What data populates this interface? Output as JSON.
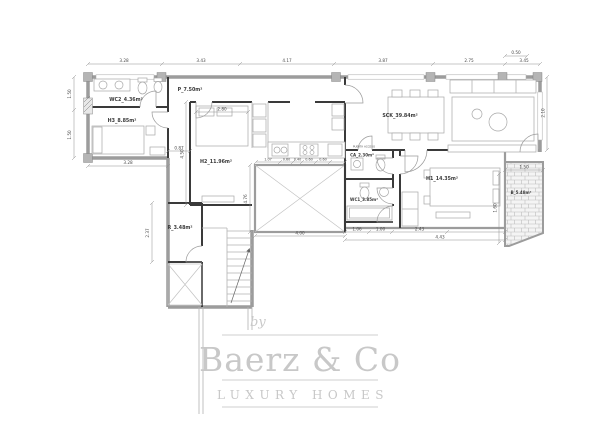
{
  "watermark": {
    "by": "by",
    "brand": "Baerz & Co",
    "tagline": "LUXURY HOMES"
  },
  "rooms": {
    "wc2": "WC2_4.36m²",
    "h3": "H3_8.85m²",
    "p": "P_7.50m²",
    "h2": "H2_11.96m²",
    "sck": "SCK_39.84m²",
    "h1": "H1_14.35m²",
    "ca": "CA_2.30m²",
    "wc1": "WC1_3.85m²",
    "r": "R_3.48m²",
    "b": "B_5.48m²",
    "entry": "PUERTA ACCESO"
  },
  "dims": {
    "top": [
      "3.28",
      "3.43",
      "4.17",
      "3.87",
      "2.75",
      "3.45"
    ],
    "top_upper": "0.50",
    "left": [
      "1.50",
      "1.50"
    ],
    "left_lower": "2.37",
    "h3_bottom": "3.28",
    "corridor": "0.87",
    "h2_left": "4.50",
    "h2_top": "2.80",
    "patio_left": "4.76",
    "patio_bottom": "4.00",
    "kitchen": [
      "1.07",
      "0.60",
      "0.40",
      "0.60",
      "0.60"
    ],
    "mid": [
      "1.06",
      "1.00",
      "2.43"
    ],
    "mid_total": "4.43",
    "terrace_top": "1.50",
    "terrace_right": "1.60",
    "sck_right": "2.10"
  },
  "colors": {
    "exterior_wall": "#9c9c9c",
    "interior_wall": "#3a3a3a",
    "watermark": "#c8c8c8"
  }
}
